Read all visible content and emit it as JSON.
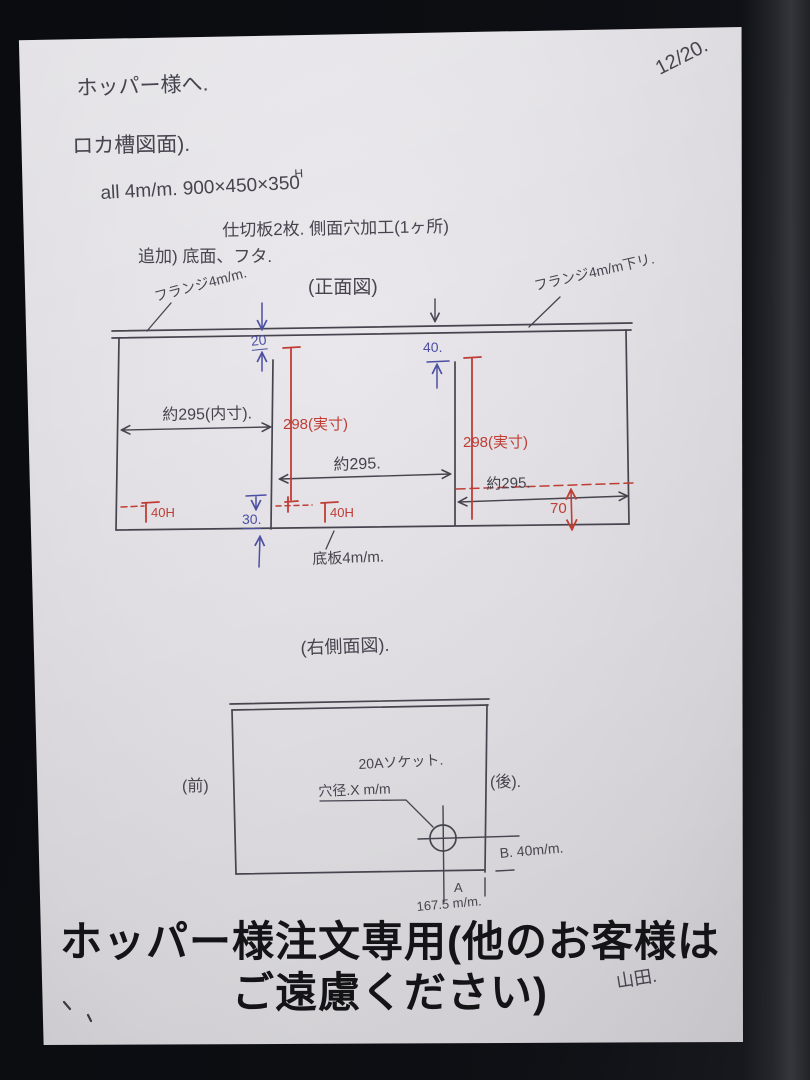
{
  "header": {
    "date": "12/20.",
    "salutation": "ホッパー様へ.",
    "doc_title": "ロカ槽図面).",
    "spec_line1": "all 4m/m. 900×450×350",
    "spec_sup": "H",
    "spec_line2": "仕切板2枚. 側面穴加工(1ヶ所)",
    "spec_line3": "追加) 底面、フタ."
  },
  "front_view": {
    "title": "(正面図)",
    "labels": {
      "flange_left": "フランジ4m/m.",
      "flange_right": "フランジ4m/m下リ.",
      "gap_20": "20",
      "gap_40": "40.",
      "width_left": "約295(内寸).",
      "partition1_height": "298(実寸)",
      "partition2_height": "298(実寸)",
      "width_mid": "約295.",
      "width_right": "約295.",
      "depth_70": "70",
      "hole_left": "40H",
      "hole_mid": "40H",
      "bottom_gap_30": "30.",
      "bottom_plate": "底板4m/m."
    }
  },
  "side_view": {
    "title": "(右側面図).",
    "labels": {
      "front_side": "(前)",
      "back_side": "(後).",
      "socket": "20Aソケット.",
      "hole_diameter": "穴径.X m/m",
      "dim_b": "B. 40m/m.",
      "dim_a": "A",
      "dim_a_value": "167.5 m/m."
    }
  },
  "footer": {
    "notice": "ホッパー様注文専用(他のお客様は\nご遠慮ください)",
    "signature": "山田."
  },
  "colors": {
    "ink": "#46444e",
    "red_pen": "#bf3d35",
    "blue_pen": "#4c4fa3",
    "paper": "#e3e1e5",
    "background": "#0c0e13",
    "print_black": "#141416"
  }
}
